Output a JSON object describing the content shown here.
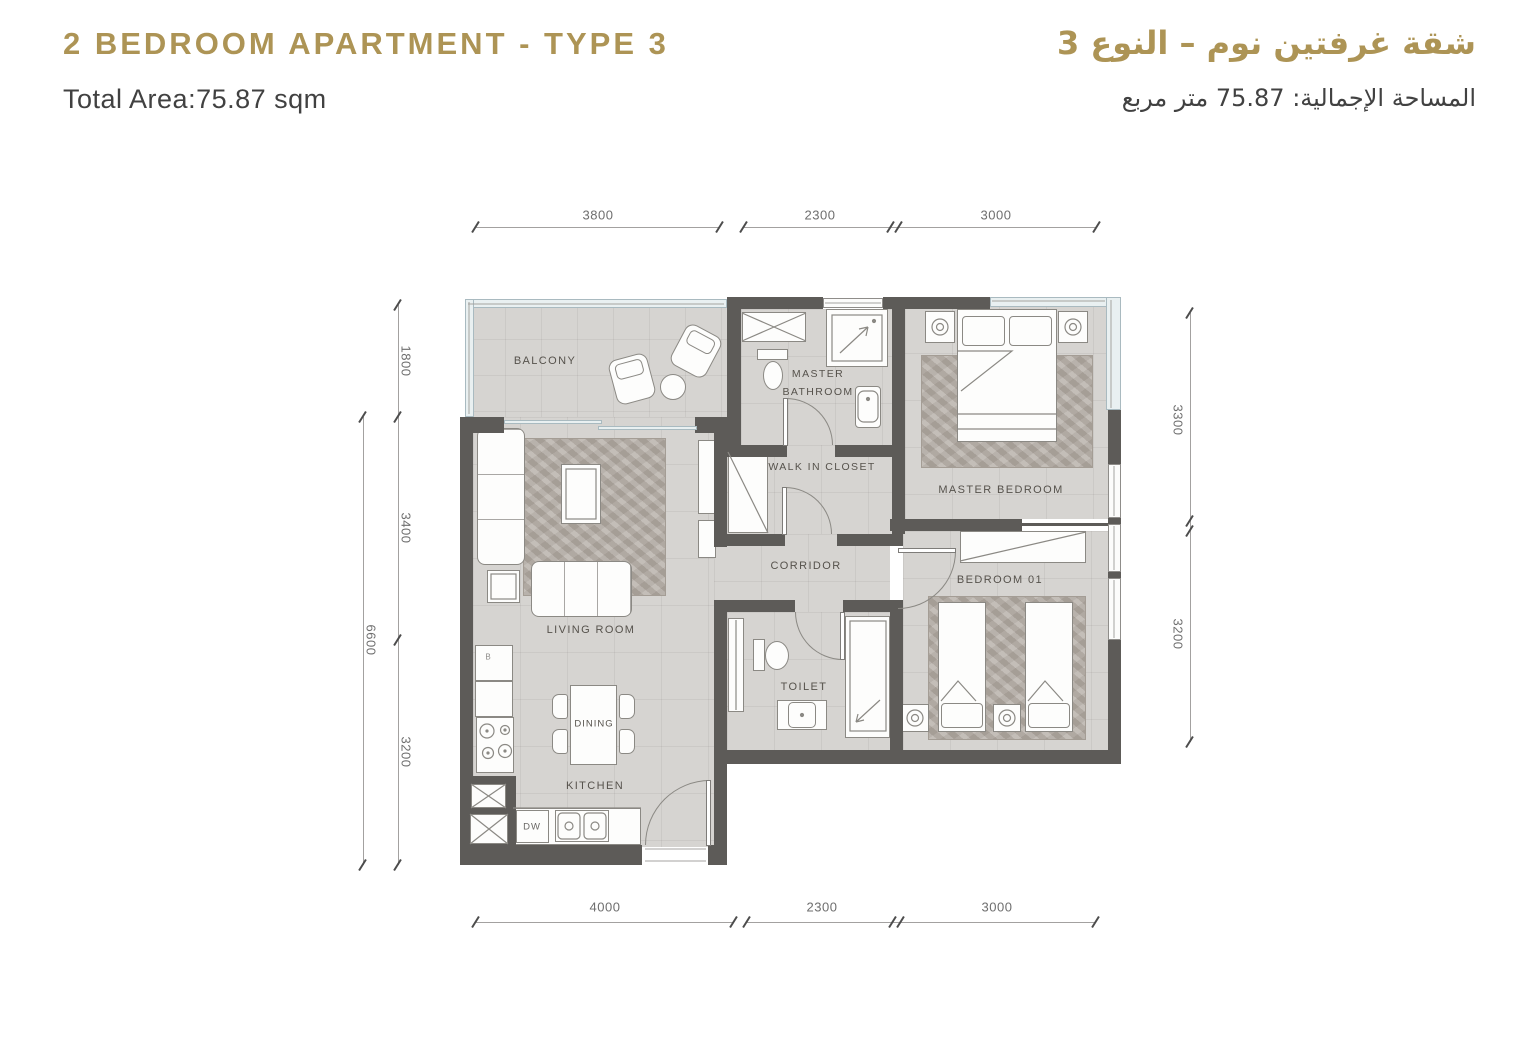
{
  "header": {
    "title_en": "2 BEDROOM APARTMENT - TYPE 3",
    "area_en": "Total Area:75.87 sqm",
    "title_ar": "شقة غرفتين نوم – النوع 3",
    "area_ar": "المساحة الإجمالية: 75.87 متر مربع"
  },
  "rooms": {
    "balcony": "BALCONY",
    "living": "LIVING ROOM",
    "dining": "DINING",
    "kitchen": "KITCHEN",
    "master_bathroom": "MASTER BATHROOM",
    "walk_in_closet": "WALK IN CLOSET",
    "corridor": "CORRIDOR",
    "master_bedroom": "MASTER BEDROOM",
    "bedroom_01": "BEDROOM 01",
    "toilet": "TOILET"
  },
  "labels": {
    "dw": "DW",
    "fridge_mark": "B"
  },
  "dims": {
    "top": [
      "3800",
      "2300",
      "3000"
    ],
    "bottom": [
      "4000",
      "2300",
      "3000"
    ],
    "left": [
      "1800",
      "3400",
      "3200"
    ],
    "left_total": "6600",
    "right": [
      "3300",
      "3200"
    ]
  },
  "colors": {
    "accent_gold": "#ad9455",
    "wall": "#5d5b58",
    "floor": "#d6d4d1",
    "text_dark": "#414141"
  }
}
